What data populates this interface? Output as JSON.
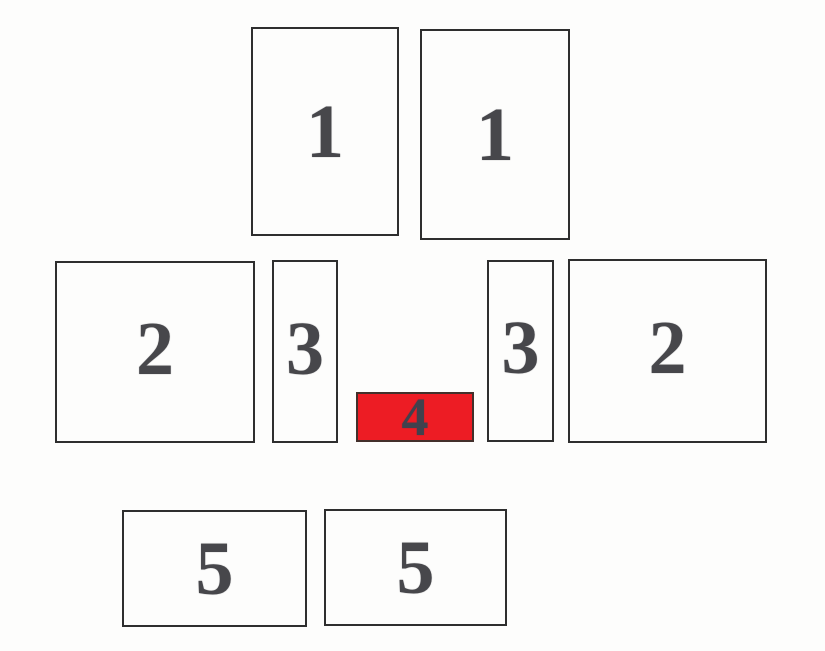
{
  "figure": {
    "paper_color": "#fdfdfc",
    "line_color": "#2e2e2e",
    "number_color": "#47474b",
    "highlight_fill": "#ed1c24",
    "highlight_border": "#43302b",
    "highlight_number_color": "#41414d"
  },
  "boxes": [
    {
      "label": "1",
      "position": "top-left",
      "highlighted": false
    },
    {
      "label": "1",
      "position": "top-right",
      "highlighted": false
    },
    {
      "label": "2",
      "position": "middle-left",
      "highlighted": false
    },
    {
      "label": "3",
      "position": "middle-center-left",
      "highlighted": false
    },
    {
      "label": "4",
      "position": "middle-center",
      "highlighted": true
    },
    {
      "label": "3",
      "position": "middle-center-right",
      "highlighted": false
    },
    {
      "label": "2",
      "position": "middle-right",
      "highlighted": false
    },
    {
      "label": "5",
      "position": "bottom-left",
      "highlighted": false
    },
    {
      "label": "5",
      "position": "bottom-right",
      "highlighted": false
    }
  ]
}
